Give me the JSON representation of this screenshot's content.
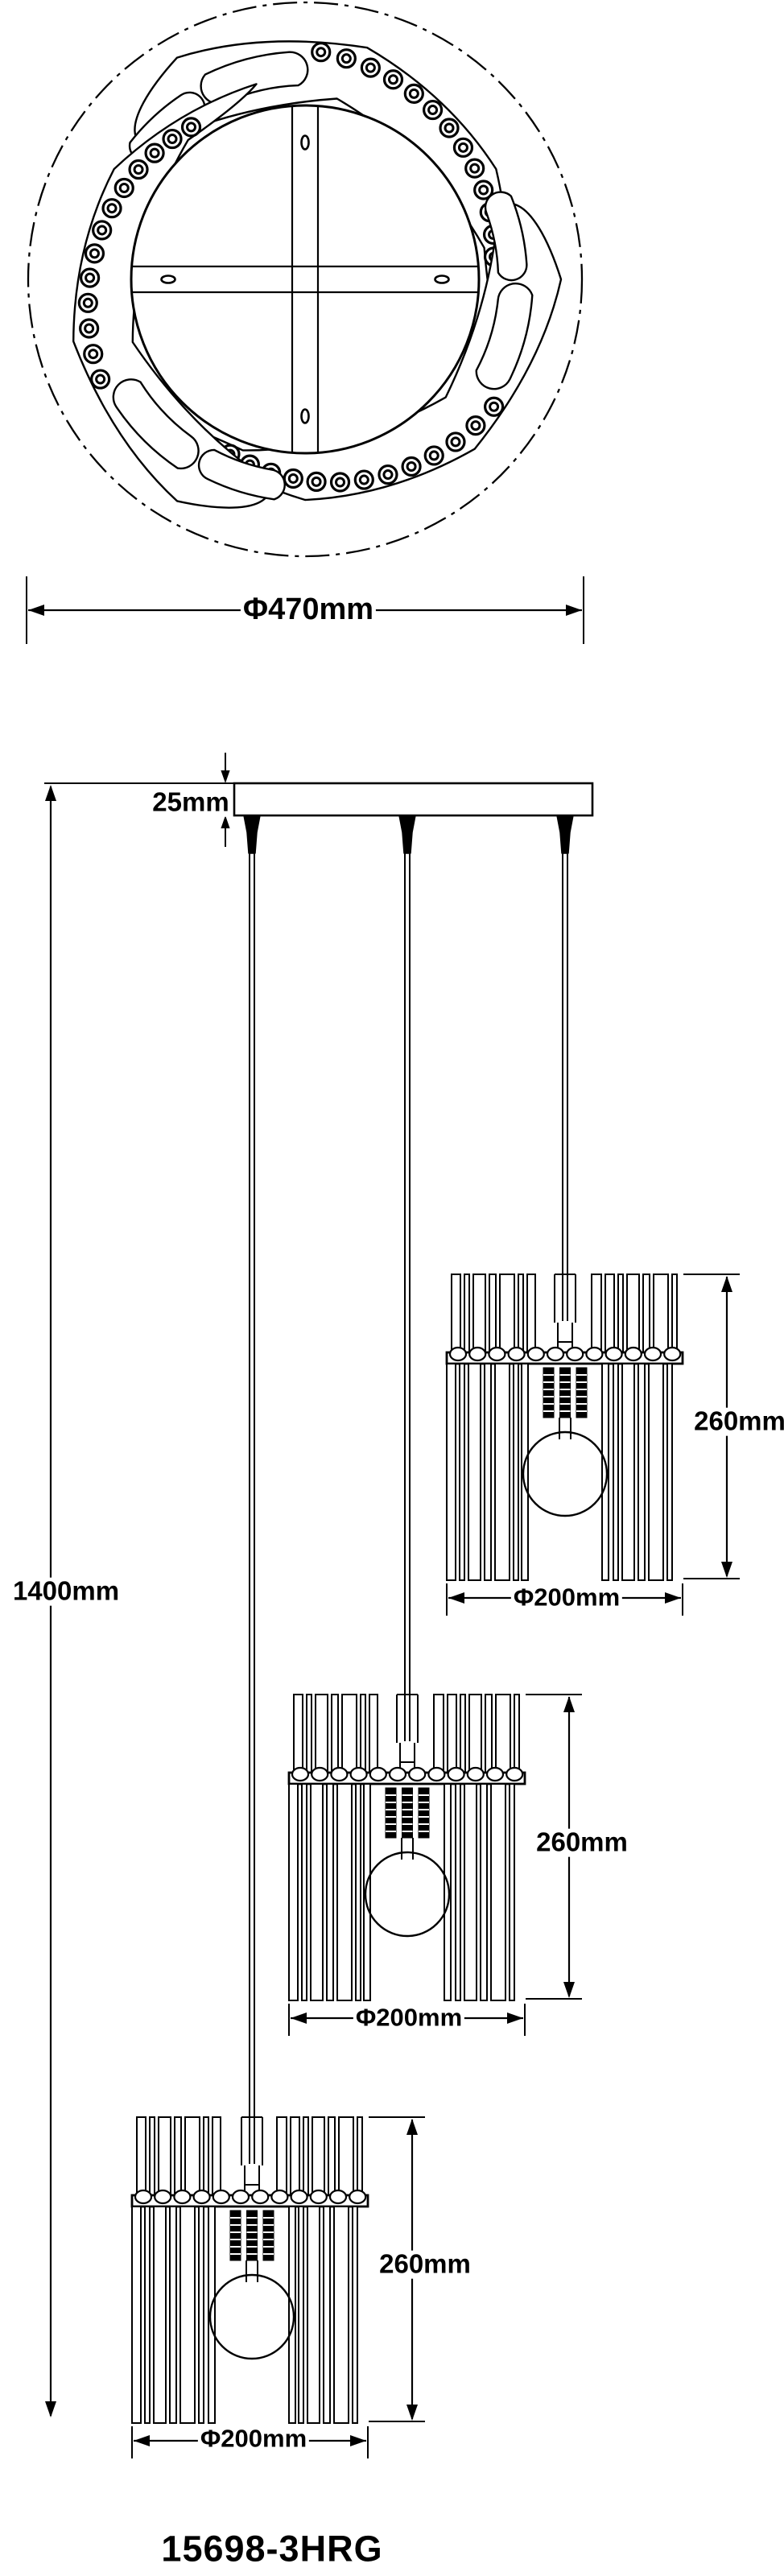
{
  "page": {
    "background": "#ffffff",
    "line_color": "#000000"
  },
  "labels": {
    "canopy_diameter": "Φ470mm",
    "plate_thickness": "25mm",
    "total_height": "1400mm",
    "model_number": "15698-3HRG",
    "shades": [
      {
        "height": "260mm",
        "diameter": "Φ200mm"
      },
      {
        "height": "260mm",
        "diameter": "Φ200mm"
      },
      {
        "height": "260mm",
        "diameter": "Φ200mm"
      }
    ]
  }
}
